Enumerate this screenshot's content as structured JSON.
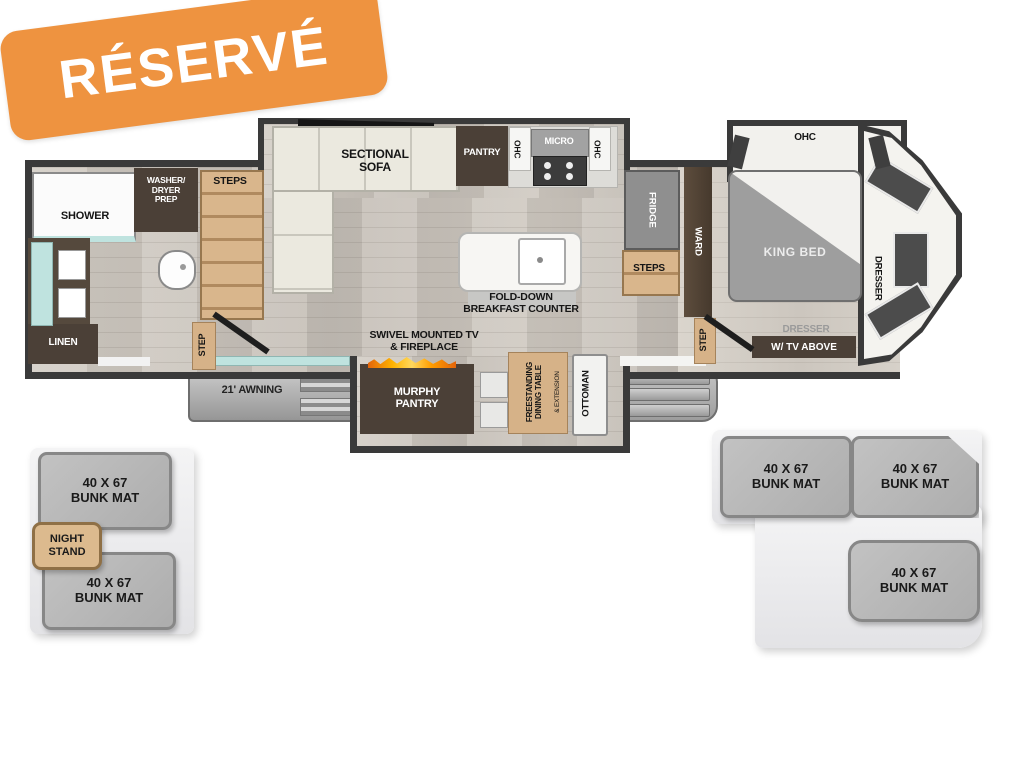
{
  "badge": {
    "text": "RÉSERVÉ"
  },
  "plan": {
    "bath": {
      "shower": "SHOWER",
      "washer_dryer_prep": "WASHER/\nDRYER\nPREP",
      "steps": "STEPS",
      "step": "STEP",
      "linen": "LINEN"
    },
    "living": {
      "sectional_sofa": "SECTIONAL\nSOFA",
      "pantry": "PANTRY",
      "ohc_left": "OHC",
      "micro": "MICRO",
      "ohc_right": "OHC",
      "island": "FOLD-DOWN\nBREAKFAST COUNTER",
      "tv_fireplace": "SWIVEL MOUNTED TV\n& FIREPLACE",
      "awning": "21' AWNING",
      "murphy_pantry": "MURPHY\nPANTRY",
      "dining_table": "FREESTANDING\nDINING TABLE",
      "dining_table_ext": "& EXTENSION",
      "ottoman": "OTTOMAN"
    },
    "bedroom": {
      "fridge": "FRIDGE",
      "steps": "STEPS",
      "ward": "WARD",
      "ohc": "OHC",
      "king_bed": "KING BED",
      "dresser": "DRESSER",
      "step": "STEP",
      "dresser_tv_line1": "DRESSER",
      "dresser_tv_line2": "W/ TV ABOVE"
    },
    "bunks": {
      "left": [
        "40 X 67\nBUNK MAT",
        "40 X 67\nBUNK MAT"
      ],
      "night_stand": "NIGHT\nSTAND",
      "right": [
        "40 X 67\nBUNK MAT",
        "40 X 67\nBUNK MAT",
        "40 X 67\nBUNK MAT"
      ]
    }
  },
  "colors": {
    "badge_orange": "#EE9340",
    "wall_dark": "#3A3A3A",
    "cabinet_brown": "#4B4037",
    "step_tan": "#D6B288",
    "flame_orange": "#F59A1E",
    "glass_teal": "#BFE3DF"
  }
}
